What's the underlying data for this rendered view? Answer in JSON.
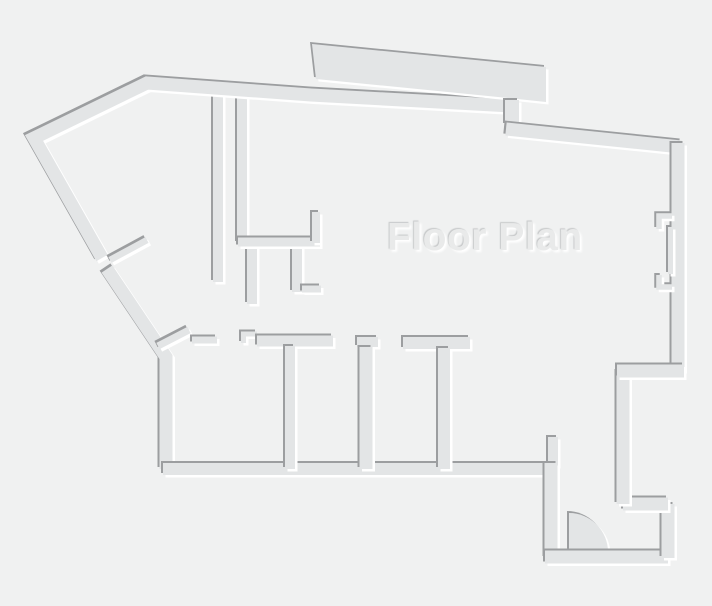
{
  "title": "Floor Plan",
  "canvas": {
    "width": 712,
    "height": 606,
    "background_color": "#f0f1f1"
  },
  "palette": {
    "wall_fill": "#e3e5e6",
    "edge_shadow_dark": "#9c9ea0",
    "edge_highlight": "#ffffff",
    "title_color": "#e9eaea",
    "title_shadow_dark": "#c6c8c9"
  },
  "floor_plan": {
    "elements": [
      {
        "name": "closet-wall-vertical-1",
        "type": "stroke",
        "d": "M218,90 L218,282",
        "w": 10
      },
      {
        "name": "closet-wall-vertical-2",
        "type": "stroke",
        "d": "M242,91 L242,243",
        "w": 10
      },
      {
        "name": "closet-stub-vertical-3",
        "type": "stroke",
        "d": "M252,246 L252,304",
        "w": 10
      },
      {
        "name": "closet-stub-vertical-4",
        "type": "stroke",
        "d": "M297,246 L297,292",
        "w": 10
      },
      {
        "name": "closet-stub-horizontal",
        "type": "stroke",
        "d": "M302,289 L321,289",
        "w": 7
      },
      {
        "name": "closet-l-wall-horizontal",
        "type": "stroke",
        "d": "M238,242 L320,242",
        "w": 9
      },
      {
        "name": "closet-l-wall-riser",
        "type": "stroke",
        "d": "M316,212 L316,243",
        "w": 8
      },
      {
        "name": "exterior-top-left-wall",
        "type": "stroke",
        "d": "M102,258 L34,138 L147,83 L311,95 L512,106",
        "w": 13
      },
      {
        "name": "bay-projection",
        "type": "fill",
        "d": "M312,44 L546,67 L546,102 L508,98 L316,79 Z"
      },
      {
        "name": "exterior-top-jog",
        "type": "stroke",
        "d": "M512,100 L512,125",
        "w": 14
      },
      {
        "name": "exterior-top-right-wall",
        "type": "stroke",
        "d": "M506,129 L681,147",
        "w": 13
      },
      {
        "name": "exterior-right-wall",
        "type": "stroke",
        "d": "M678,143 L678,371",
        "w": 13
      },
      {
        "name": "right-notch-upper",
        "type": "stroke",
        "d": "M672,216 L659,216 L659,229",
        "w": 5.5
      },
      {
        "name": "right-notch-strip",
        "type": "stroke",
        "d": "M670.5,227 L670.5,274",
        "w": 5
      },
      {
        "name": "right-notch-lower",
        "type": "stroke",
        "d": "M659,275 L659,287 L672,287",
        "w": 5.5
      },
      {
        "name": "exterior-left-diagonal-lower",
        "type": "stroke",
        "d": "M107,269 L166,357 L166,469",
        "w": 13
      },
      {
        "name": "rooms-bottom-wall",
        "type": "stroke",
        "d": "M163,469 L553,469",
        "w": 12
      },
      {
        "name": "door-leaf-left-diagonal",
        "type": "stroke",
        "d": "M110,260 L147,240",
        "w": 6.5
      },
      {
        "name": "door-leaf-rooms",
        "type": "stroke",
        "d": "M158,346 L189,330",
        "w": 7
      },
      {
        "name": "rooms-top-wall-a",
        "type": "stroke",
        "d": "M192,340 L217,340",
        "w": 7
      },
      {
        "name": "rooms-top-wall-step",
        "type": "stroke",
        "d": "M243.5,343 L243.5,334 L257,334",
        "w": 5
      },
      {
        "name": "rooms-top-wall-b",
        "type": "stroke",
        "d": "M257,341 L333,341",
        "w": 11
      },
      {
        "name": "room-divider-1",
        "type": "stroke",
        "d": "M290,346 L290,469",
        "w": 10
      },
      {
        "name": "rooms-top-wall-c",
        "type": "stroke",
        "d": "M357,342 L378,342",
        "w": 10
      },
      {
        "name": "room-divider-2",
        "type": "stroke",
        "d": "M366,347 L366,469",
        "w": 13
      },
      {
        "name": "rooms-top-wall-d",
        "type": "stroke",
        "d": "M403,343 L470,343",
        "w": 12
      },
      {
        "name": "room-divider-3",
        "type": "stroke",
        "d": "M444,348 L444,469",
        "w": 12
      },
      {
        "name": "entry-stub",
        "type": "stroke",
        "d": "M553,437 L553,466",
        "w": 10
      },
      {
        "name": "entry-left-wall",
        "type": "stroke",
        "d": "M551,463 L551,558",
        "w": 13
      },
      {
        "name": "door-swing",
        "type": "fill",
        "d": "M569,552 L569,513 A39,39 0 0 1 608,552 Z"
      },
      {
        "name": "entry-bottom-wall",
        "type": "stroke",
        "d": "M545,557 L668,557",
        "w": 13
      },
      {
        "name": "entry-right-wall",
        "type": "stroke",
        "d": "M668,504 L668,558",
        "w": 13
      },
      {
        "name": "bottom-right-mid-wall",
        "type": "stroke",
        "d": "M668,504 L623,504",
        "w": 13
      },
      {
        "name": "bottom-right-left-wall",
        "type": "stroke",
        "d": "M623,371 L623,504",
        "w": 13
      },
      {
        "name": "bottom-right-top-wall",
        "type": "stroke",
        "d": "M684,371 L617,371",
        "w": 13
      }
    ]
  }
}
